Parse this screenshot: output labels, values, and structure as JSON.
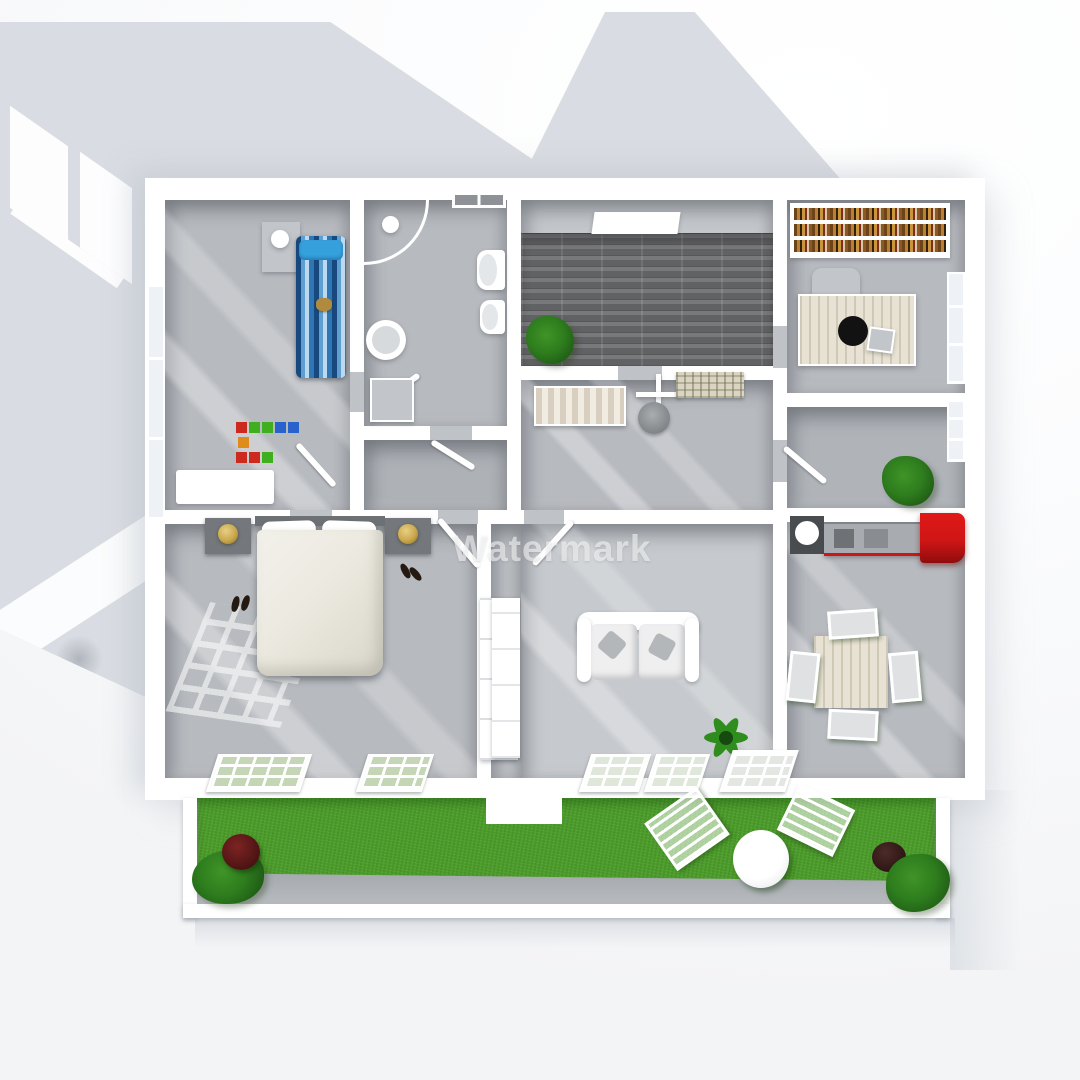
{
  "watermark": {
    "text": "Watermark"
  },
  "palette": {
    "background": "#f7f8fa",
    "shadow": "#d9dce2",
    "wall": "#ffffff",
    "floor": "#b7babf",
    "floor_dark_tile": "#6e6f71",
    "lawn": "#4c9e2b",
    "garden_path": "#9da2a6",
    "kids_bed_blue": "#2f76b4",
    "kids_pillow_blue": "#35a0dc",
    "kitchen_red": "#cf1616",
    "plant_green": "#2e7d1e",
    "lamp_gold": "#c9a84c",
    "duvet_cream": "#ece9e0",
    "wood_light": "#e7e2d4",
    "radiator_beige": "#d9d5c2",
    "toy_colors": [
      "#cc2a1e",
      "#3fae1f",
      "#2a62cc",
      "#e08c1a"
    ]
  },
  "semantics": {
    "scene": "3d-floor-plan-top-view",
    "rooms": [
      "kids-bedroom",
      "bathroom",
      "closet",
      "entry-hall",
      "laundry-room",
      "office",
      "pantry",
      "kitchen-dining",
      "master-bedroom",
      "living-room",
      "garden"
    ],
    "furniture": [
      "kids-bed",
      "toy-blocks",
      "dresser",
      "shower",
      "toilet",
      "bidet",
      "round-sink",
      "washing-machine",
      "hall-plant",
      "slat-bench",
      "drying-rack",
      "wash-basin",
      "wall-radiator",
      "bookshelf",
      "desk",
      "office-chair",
      "monitor",
      "kitchen-counter",
      "red-fridge",
      "dining-table",
      "dining-chairs",
      "double-bed",
      "nightstands",
      "gold-lamps",
      "shoes",
      "wardrobe",
      "sofa",
      "star-plant",
      "tv-cabinet",
      "garden-table",
      "garden-chairs",
      "potted-plants",
      "lawn",
      "garden-path"
    ]
  }
}
